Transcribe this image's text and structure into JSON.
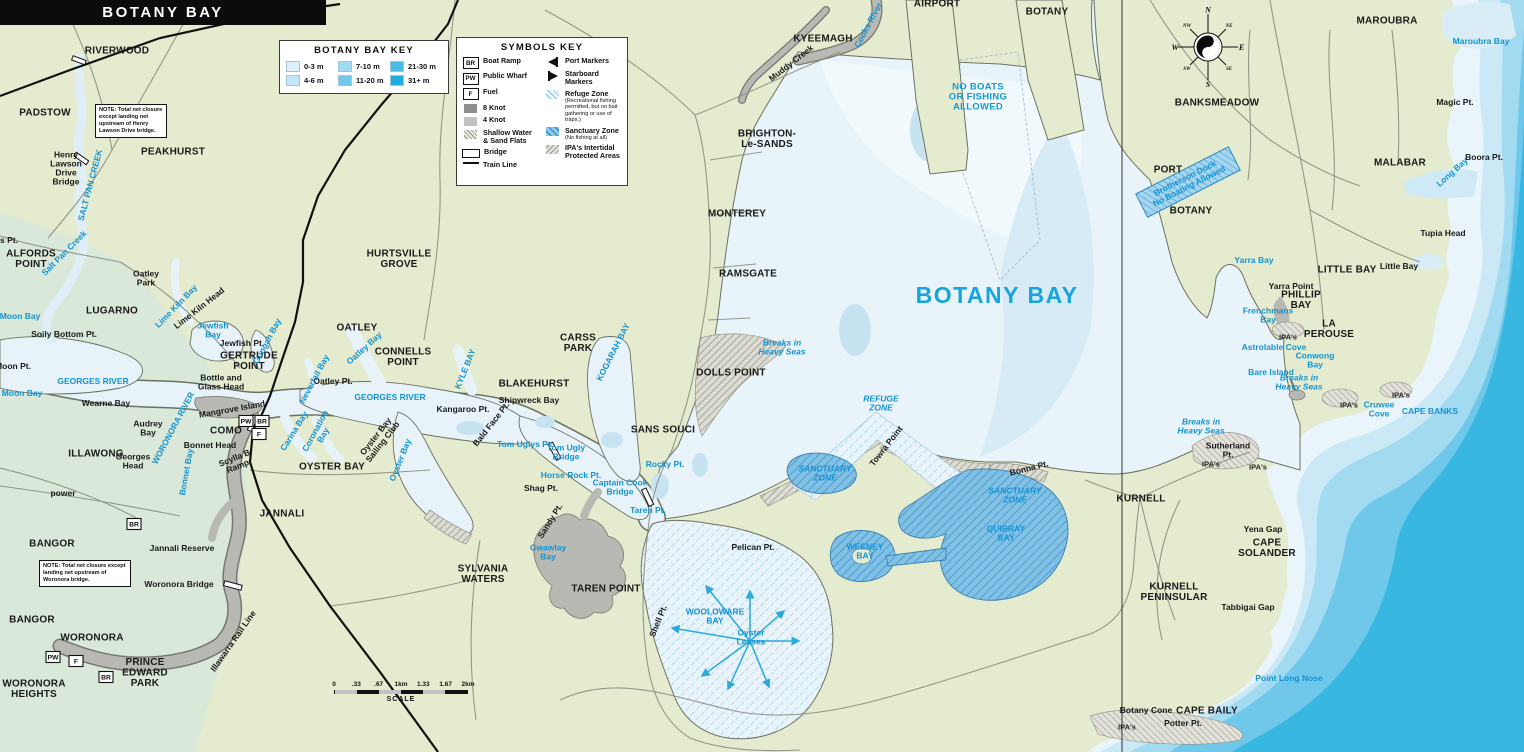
{
  "title": "BOTANY BAY",
  "depth_key": {
    "title": "BOTANY BAY KEY",
    "entries": [
      {
        "label": "0-3 m",
        "color": "#ddf0fa"
      },
      {
        "label": "4-6 m",
        "color": "#c2e6f6"
      },
      {
        "label": "7-10 m",
        "color": "#9fd9f2"
      },
      {
        "label": "11-20 m",
        "color": "#72c9ec"
      },
      {
        "label": "21-30 m",
        "color": "#49bbe6"
      },
      {
        "label": "31+ m",
        "color": "#1fade0"
      }
    ]
  },
  "symbols_key": {
    "title": "SYMBOLS KEY",
    "left": [
      {
        "icon": "box",
        "glyph": "BR",
        "label": "Boat Ramp"
      },
      {
        "icon": "box",
        "glyph": "PW",
        "label": "Public Wharf"
      },
      {
        "icon": "box",
        "glyph": "F",
        "label": "Fuel"
      },
      {
        "icon": "swatch",
        "color": "#8f8f8f",
        "label": "8 Knot"
      },
      {
        "icon": "swatch",
        "color": "#c2c2c2",
        "label": "4 Knot"
      },
      {
        "icon": "hatch-gray",
        "label": "Shallow Water\n& Sand Flats"
      },
      {
        "icon": "bridge",
        "label": "Bridge"
      },
      {
        "icon": "train",
        "label": "Train Line"
      }
    ],
    "right": [
      {
        "icon": "port",
        "label": "Port Markers"
      },
      {
        "icon": "starboard",
        "label": "Starboard Markers"
      },
      {
        "icon": "hatch-refuge",
        "label": "Refuge Zone",
        "sub": "(Recreational fishing permitted, but no bait gathering or use of traps.)"
      },
      {
        "icon": "hatch-sanctuary",
        "label": "Sanctuary Zone",
        "sub": "(No fishing at all)"
      },
      {
        "icon": "hatch-ipa",
        "label": "IPA's Intertidal\nProtected Areas"
      }
    ]
  },
  "notes": [
    {
      "text": "NOTE: Total net closure except landing net upstream of Henry Lawson Drive bridge."
    },
    {
      "text": "NOTE: Total net closure except landing net upstream of Woronora bridge."
    }
  ],
  "scale_bar": {
    "ticks": [
      "0",
      ".33",
      ".67",
      "1km",
      "1.33",
      "1.67",
      "2km"
    ],
    "label": "SCALE"
  },
  "compass": {
    "n": "N",
    "e": "E",
    "s": "S",
    "w": "W",
    "ne": "NE",
    "nw": "NW",
    "se": "SE",
    "sw": "SW"
  },
  "colors": {
    "land": "#e4ebcf",
    "bay": "#e9f3fa",
    "ocean_deep": "#38b7e1",
    "water_label": "#1593d2",
    "sanctuary": "#79bce4",
    "knot8": "#b7b7af"
  },
  "map_labels": [
    {
      "t": "RIVERWOOD",
      "x": 117,
      "y": 50,
      "c": "sub"
    },
    {
      "t": "PADSTOW",
      "x": 45,
      "y": 112,
      "c": "sub"
    },
    {
      "t": "PEAKHURST",
      "x": 173,
      "y": 151,
      "c": "sub"
    },
    {
      "t": "HURTSVILLE\nGROVE",
      "x": 399,
      "y": 258,
      "c": "sub"
    },
    {
      "t": "OATLEY",
      "x": 357,
      "y": 327,
      "c": "sub"
    },
    {
      "t": "ALFORDS\nPOINT",
      "x": 31,
      "y": 258,
      "c": "sub"
    },
    {
      "t": "LUGARNO",
      "x": 112,
      "y": 310,
      "c": "sub"
    },
    {
      "t": "GERTRUDE\nPOINT",
      "x": 249,
      "y": 360,
      "c": "sub"
    },
    {
      "t": "CONNELLS\nPOINT",
      "x": 403,
      "y": 356,
      "c": "sub"
    },
    {
      "t": "BLAKEHURST",
      "x": 534,
      "y": 383,
      "c": "sub"
    },
    {
      "t": "CARSS\nPARK",
      "x": 578,
      "y": 342,
      "c": "sub"
    },
    {
      "t": "KYEEMAGH",
      "x": 823,
      "y": 38,
      "c": "sub"
    },
    {
      "t": "BRIGHTON-\nLe-SANDS",
      "x": 767,
      "y": 138,
      "c": "sub"
    },
    {
      "t": "MONTEREY",
      "x": 737,
      "y": 213,
      "c": "sub"
    },
    {
      "t": "RAMSGATE",
      "x": 748,
      "y": 273,
      "c": "sub"
    },
    {
      "t": "DOLLS POINT",
      "x": 731,
      "y": 372,
      "c": "sub"
    },
    {
      "t": "SANS SOUCI",
      "x": 663,
      "y": 429,
      "c": "sub"
    },
    {
      "t": "OYSTER BAY",
      "x": 332,
      "y": 466,
      "c": "sub"
    },
    {
      "t": "JANNALI",
      "x": 282,
      "y": 513,
      "c": "sub"
    },
    {
      "t": "COMO",
      "x": 226,
      "y": 430,
      "c": "sub"
    },
    {
      "t": "ILLAWONG",
      "x": 96,
      "y": 453,
      "c": "sub"
    },
    {
      "t": "BANGOR",
      "x": 52,
      "y": 543,
      "c": "sub"
    },
    {
      "t": "BANGOR",
      "x": 32,
      "y": 619,
      "c": "sub"
    },
    {
      "t": "WORONORA",
      "x": 92,
      "y": 637,
      "c": "sub"
    },
    {
      "t": "PRINCE\nEDWARD\nPARK",
      "x": 145,
      "y": 672,
      "c": "sub"
    },
    {
      "t": "WORONORA\nHEIGHTS",
      "x": 34,
      "y": 688,
      "c": "sub"
    },
    {
      "t": "SYLVANIA\nWATERS",
      "x": 483,
      "y": 573,
      "c": "sub"
    },
    {
      "t": "TAREN POINT",
      "x": 606,
      "y": 588,
      "c": "sub"
    },
    {
      "t": "AIRPORT",
      "x": 937,
      "y": 3,
      "c": "sub"
    },
    {
      "t": "BOTANY",
      "x": 1047,
      "y": 11,
      "c": "sub"
    },
    {
      "t": "BANKSMEADOW",
      "x": 1217,
      "y": 102,
      "c": "sub"
    },
    {
      "t": "PORT",
      "x": 1168,
      "y": 169,
      "c": "sub"
    },
    {
      "t": "BOTANY",
      "x": 1191,
      "y": 210,
      "c": "sub"
    },
    {
      "t": "MAROUBRA",
      "x": 1387,
      "y": 20,
      "c": "sub"
    },
    {
      "t": "MALABAR",
      "x": 1400,
      "y": 162,
      "c": "sub"
    },
    {
      "t": "LITTLE BAY",
      "x": 1347,
      "y": 269,
      "c": "sub"
    },
    {
      "t": "PHILLIP\nBAY",
      "x": 1301,
      "y": 299,
      "c": "sub"
    },
    {
      "t": "LA\nPEROUSE",
      "x": 1329,
      "y": 328,
      "c": "sub"
    },
    {
      "t": "KURNELL",
      "x": 1141,
      "y": 498,
      "c": "sub"
    },
    {
      "t": "KURNELL\nPENINSULAR",
      "x": 1174,
      "y": 591,
      "c": "sub"
    },
    {
      "t": "CAPE\nSOLANDER",
      "x": 1267,
      "y": 547,
      "c": "sub"
    },
    {
      "t": "CAPE BAILY",
      "x": 1207,
      "y": 710,
      "c": "sub"
    },
    {
      "t": "BOTANY BAY",
      "x": 997,
      "y": 295,
      "c": "big"
    },
    {
      "t": "Henry\nLawson\nDrive\nBridge",
      "x": 66,
      "y": 168,
      "c": "pl"
    },
    {
      "t": "Oatley\nPark",
      "x": 146,
      "y": 278,
      "c": "pl"
    },
    {
      "t": "Lime Kiln Head",
      "x": 199,
      "y": 308,
      "c": "pl",
      "r": -38
    },
    {
      "t": "Jewfish Pt.",
      "x": 242,
      "y": 343,
      "c": "pl"
    },
    {
      "t": "Soily Bottom Pt.",
      "x": 64,
      "y": 334,
      "c": "pl"
    },
    {
      "t": "Moon Pt.",
      "x": 13,
      "y": 366,
      "c": "pl"
    },
    {
      "t": "Wearne Bay",
      "x": 106,
      "y": 403,
      "c": "pl"
    },
    {
      "t": "Bottle and\nGlass Head",
      "x": 221,
      "y": 382,
      "c": "pl"
    },
    {
      "t": "Mangrove Island",
      "x": 232,
      "y": 409,
      "c": "pl",
      "r": -10
    },
    {
      "t": "Audrey\nBay",
      "x": 148,
      "y": 428,
      "c": "pl"
    },
    {
      "t": "Georges\nHead",
      "x": 133,
      "y": 461,
      "c": "pl"
    },
    {
      "t": "Bonnet Head",
      "x": 210,
      "y": 445,
      "c": "pl"
    },
    {
      "t": "Scylla B\nRamp",
      "x": 236,
      "y": 462,
      "c": "pl",
      "r": -22
    },
    {
      "t": "power",
      "x": 63,
      "y": 493,
      "c": "pl"
    },
    {
      "t": "Jannali Reserve",
      "x": 182,
      "y": 548,
      "c": "pl"
    },
    {
      "t": "Woronora Bridge",
      "x": 179,
      "y": 584,
      "c": "pl"
    },
    {
      "t": "Oatley Pt.",
      "x": 333,
      "y": 381,
      "c": "pl"
    },
    {
      "t": "Kangaroo Pt.",
      "x": 463,
      "y": 409,
      "c": "pl"
    },
    {
      "t": "Bald Face Pt.",
      "x": 491,
      "y": 424,
      "c": "pl",
      "r": -52
    },
    {
      "t": "Shipwreck Bay",
      "x": 529,
      "y": 400,
      "c": "pl"
    },
    {
      "t": "Shag Pt.",
      "x": 541,
      "y": 488,
      "c": "pl"
    },
    {
      "t": "Sandy Pt.",
      "x": 550,
      "y": 521,
      "c": "pl",
      "r": -58
    },
    {
      "t": "Shell Pt.",
      "x": 658,
      "y": 621,
      "c": "pl",
      "r": -68
    },
    {
      "t": "Pelican Pt.",
      "x": 753,
      "y": 547,
      "c": "pl"
    },
    {
      "t": "Towra Point",
      "x": 886,
      "y": 446,
      "c": "pl",
      "r": -52
    },
    {
      "t": "Bonna Pt.",
      "x": 1029,
      "y": 468,
      "c": "pl",
      "r": -14
    },
    {
      "t": "Yena Gap",
      "x": 1263,
      "y": 529,
      "c": "pl"
    },
    {
      "t": "Tabbigai Gap",
      "x": 1248,
      "y": 607,
      "c": "pl"
    },
    {
      "t": "Botany Cone",
      "x": 1146,
      "y": 710,
      "c": "pl"
    },
    {
      "t": "Potter Pt.",
      "x": 1183,
      "y": 723,
      "c": "pl"
    },
    {
      "t": "Yarra Point",
      "x": 1291,
      "y": 286,
      "c": "pl"
    },
    {
      "t": "Little Bay",
      "x": 1399,
      "y": 266,
      "c": "pl"
    },
    {
      "t": "Boora Pt.",
      "x": 1484,
      "y": 157,
      "c": "pl"
    },
    {
      "t": "Tupia Head",
      "x": 1443,
      "y": 233,
      "c": "pl"
    },
    {
      "t": "Magic Pt.",
      "x": 1455,
      "y": 102,
      "c": "pl"
    },
    {
      "t": "Sutherland\nPt.",
      "x": 1228,
      "y": 450,
      "c": "pl"
    },
    {
      "t": "Muddy Creek",
      "x": 791,
      "y": 63,
      "c": "pl",
      "r": -38
    },
    {
      "t": "Oyster Bay\nSailing Club",
      "x": 379,
      "y": 439,
      "c": "pl",
      "r": -52
    },
    {
      "t": "Illawarra Rail Line",
      "x": 233,
      "y": 641,
      "c": "pl",
      "r": -55
    },
    {
      "t": "s Pt.",
      "x": 9,
      "y": 240,
      "c": "pl"
    },
    {
      "t": "SALT PAN CREEK",
      "x": 90,
      "y": 185,
      "c": "wtr",
      "r": -75
    },
    {
      "t": "Salt Pan Creek",
      "x": 64,
      "y": 253,
      "c": "wtr",
      "r": -45
    },
    {
      "t": "Moon Bay",
      "x": 20,
      "y": 316,
      "c": "wtr"
    },
    {
      "t": "Moon Bay",
      "x": 22,
      "y": 393,
      "c": "wtr"
    },
    {
      "t": "Lime Kiln Bay",
      "x": 176,
      "y": 306,
      "c": "wtr",
      "r": -46
    },
    {
      "t": "Jewfish\nBay",
      "x": 213,
      "y": 330,
      "c": "wtr"
    },
    {
      "t": "Gungah Bay",
      "x": 267,
      "y": 341,
      "c": "wtr",
      "r": -62
    },
    {
      "t": "GEORGES RIVER",
      "x": 93,
      "y": 381,
      "c": "wtr"
    },
    {
      "t": "GEORGES RIVER",
      "x": 390,
      "y": 397,
      "c": "wtr"
    },
    {
      "t": "Neverfail Bay",
      "x": 314,
      "y": 379,
      "c": "wtr",
      "r": -62
    },
    {
      "t": "Oatley Bay",
      "x": 364,
      "y": 348,
      "c": "wtr",
      "r": -42
    },
    {
      "t": "KYLE BAY",
      "x": 465,
      "y": 369,
      "c": "wtr",
      "r": -68
    },
    {
      "t": "Carina Bay",
      "x": 294,
      "y": 431,
      "c": "wtr",
      "r": -58
    },
    {
      "t": "Coronation\nBay",
      "x": 319,
      "y": 433,
      "c": "wtr",
      "r": -62
    },
    {
      "t": "WORONORA RIVER",
      "x": 173,
      "y": 428,
      "c": "wtr",
      "r": -62
    },
    {
      "t": "Bonnet Bay",
      "x": 186,
      "y": 472,
      "c": "wtr",
      "r": -80
    },
    {
      "t": "Oyster Bay",
      "x": 400,
      "y": 460,
      "c": "wtr",
      "r": -68
    },
    {
      "t": "KOGARAH BAY",
      "x": 613,
      "y": 352,
      "c": "wtr",
      "r": -63
    },
    {
      "t": "Tom Uglys Pt.",
      "x": 525,
      "y": 444,
      "c": "wtr"
    },
    {
      "t": "Tom Ugly\nBridge",
      "x": 566,
      "y": 452,
      "c": "wtr"
    },
    {
      "t": "Horse Rock Pt.",
      "x": 571,
      "y": 475,
      "c": "wtr"
    },
    {
      "t": "Captain Cook\nBridge",
      "x": 620,
      "y": 487,
      "c": "wtr"
    },
    {
      "t": "Rocky Pt.",
      "x": 665,
      "y": 464,
      "c": "wtr"
    },
    {
      "t": "Taren Pt.",
      "x": 648,
      "y": 510,
      "c": "wtr"
    },
    {
      "t": "Gwawlay\nBay",
      "x": 548,
      "y": 552,
      "c": "wtr"
    },
    {
      "t": "WOOLOWARE\nBAY",
      "x": 715,
      "y": 616,
      "c": "wtr"
    },
    {
      "t": "Oyster\nLeases",
      "x": 751,
      "y": 637,
      "c": "wtr"
    },
    {
      "t": "Cooks  River",
      "x": 868,
      "y": 25,
      "c": "wtr",
      "r": -62
    },
    {
      "t": "Maroubra Bay",
      "x": 1481,
      "y": 41,
      "c": "wtr"
    },
    {
      "t": "Long Bay",
      "x": 1452,
      "y": 172,
      "c": "wtr",
      "r": -42
    },
    {
      "t": "Yarra Bay",
      "x": 1254,
      "y": 260,
      "c": "wtr"
    },
    {
      "t": "Frenchmans\nBay",
      "x": 1268,
      "y": 315,
      "c": "wtr"
    },
    {
      "t": "Astrolable Cove",
      "x": 1274,
      "y": 347,
      "c": "wtr"
    },
    {
      "t": "Conwong\nBay",
      "x": 1315,
      "y": 360,
      "c": "wtr"
    },
    {
      "t": "Bare Island",
      "x": 1271,
      "y": 372,
      "c": "wtr"
    },
    {
      "t": "Cruwee\nCove",
      "x": 1379,
      "y": 409,
      "c": "wtr"
    },
    {
      "t": "CAPE BANKS",
      "x": 1430,
      "y": 411,
      "c": "wtr"
    },
    {
      "t": "Point Long Nose",
      "x": 1289,
      "y": 678,
      "c": "wtr"
    },
    {
      "t": "Brotherson Dock\nNo Boating Allowed",
      "x": 1187,
      "y": 182,
      "c": "wtr",
      "r": -27
    },
    {
      "t": "QUIBRAY\nBAY",
      "x": 1006,
      "y": 533,
      "c": "wtr"
    },
    {
      "t": "WEENEY\nBAY",
      "x": 865,
      "y": 551,
      "c": "wtr"
    },
    {
      "t": "Breaks in\nHeavy Seas",
      "x": 782,
      "y": 347,
      "c": "zn"
    },
    {
      "t": "Breaks in\nHeavy Seas",
      "x": 1201,
      "y": 426,
      "c": "zn"
    },
    {
      "t": "Breaks in\nHeavy Seas",
      "x": 1299,
      "y": 382,
      "c": "zn"
    },
    {
      "t": "REFUGE\nZONE",
      "x": 881,
      "y": 403,
      "c": "zn"
    },
    {
      "t": "SANCTUARY\nZONE",
      "x": 825,
      "y": 473,
      "c": "zn"
    },
    {
      "t": "SANCTUARY\nZONE",
      "x": 1015,
      "y": 495,
      "c": "zn"
    },
    {
      "t": "NO BOATS\nOR FISHING\nALLOWED",
      "x": 978,
      "y": 96,
      "c": "zn2"
    },
    {
      "t": "IPA's",
      "x": 1288,
      "y": 337,
      "c": "ipa"
    },
    {
      "t": "IPA's",
      "x": 1349,
      "y": 405,
      "c": "ipa"
    },
    {
      "t": "IPA's",
      "x": 1401,
      "y": 395,
      "c": "ipa"
    },
    {
      "t": "IPA's",
      "x": 1211,
      "y": 464,
      "c": "ipa"
    },
    {
      "t": "IPA's",
      "x": 1258,
      "y": 467,
      "c": "ipa"
    },
    {
      "t": "IPA's",
      "x": 1127,
      "y": 727,
      "c": "ipa"
    }
  ],
  "symbol_markers": [
    {
      "g": "PW",
      "x": 246,
      "y": 421
    },
    {
      "g": "BR",
      "x": 262,
      "y": 421
    },
    {
      "g": "F",
      "x": 259,
      "y": 434
    },
    {
      "g": "BR",
      "x": 134,
      "y": 524
    },
    {
      "g": "PW",
      "x": 53,
      "y": 657
    },
    {
      "g": "F",
      "x": 76,
      "y": 661
    },
    {
      "g": "BR",
      "x": 106,
      "y": 677
    }
  ]
}
